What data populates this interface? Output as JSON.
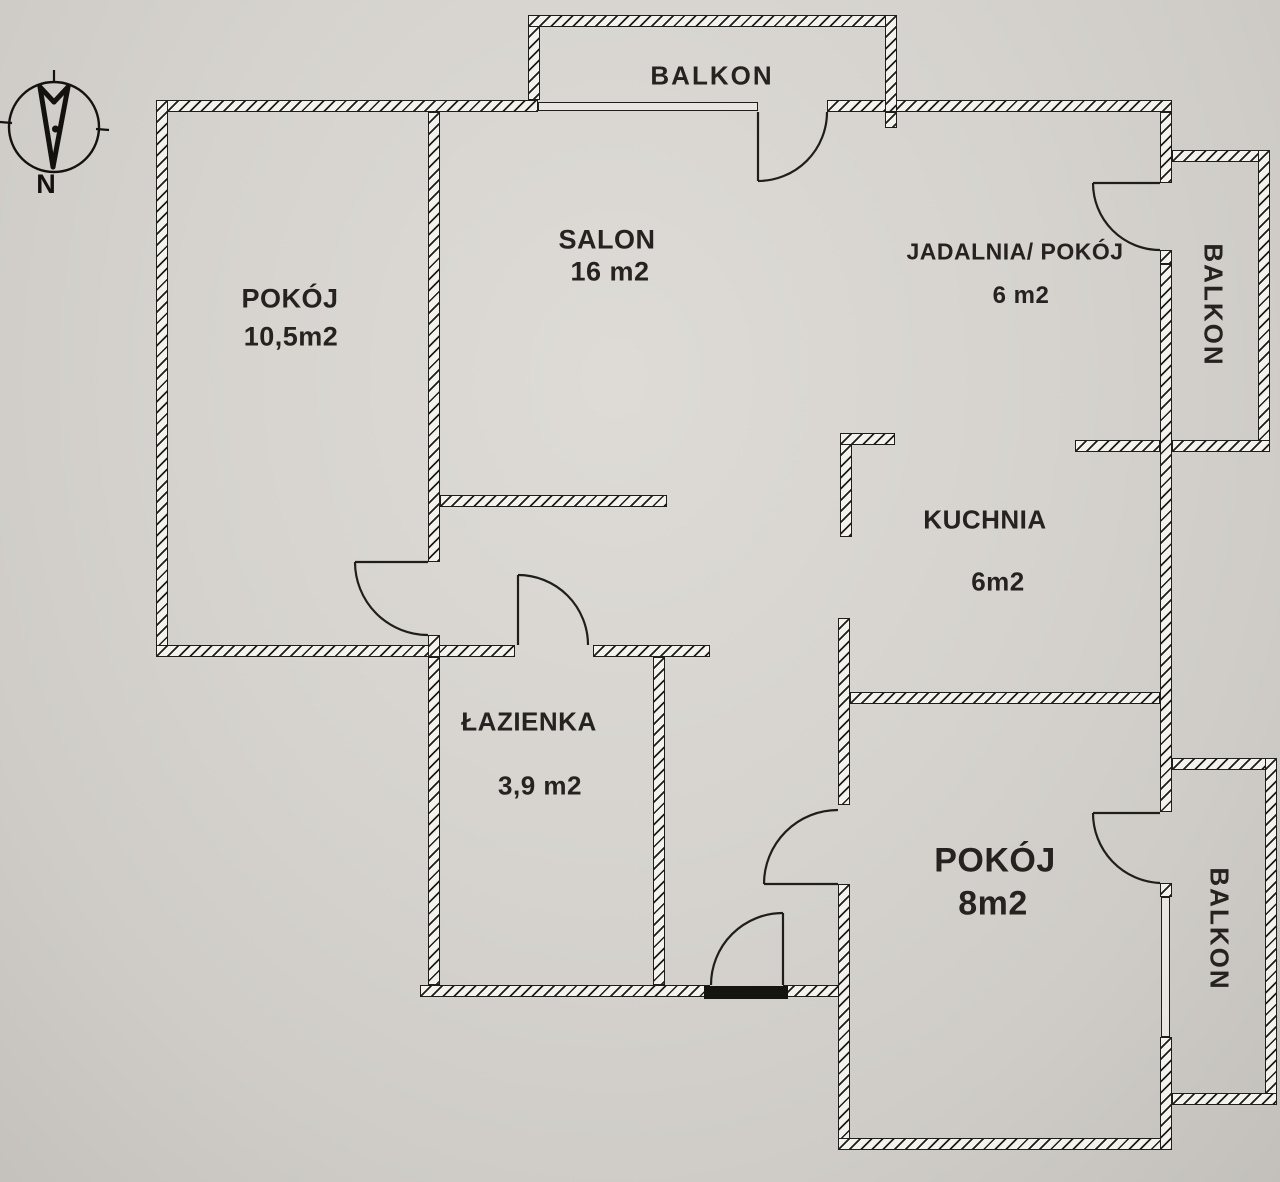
{
  "plan": {
    "title_hint": "apartment floor plan",
    "compass": {
      "north_label": "N"
    },
    "rooms": [
      {
        "id": "balkon-top",
        "label": "BALKON",
        "area": ""
      },
      {
        "id": "pokoj-1",
        "label": "POKÓJ",
        "area": "10,5m2"
      },
      {
        "id": "salon",
        "label": "SALON",
        "area": "16 m2"
      },
      {
        "id": "jadalnia-pokoj",
        "label": "JADALNIA/ POKÓJ",
        "area": "6 m2"
      },
      {
        "id": "balkon-right-upper",
        "label": "BALKON",
        "area": ""
      },
      {
        "id": "kuchnia",
        "label": "KUCHNIA",
        "area": "6m2"
      },
      {
        "id": "lazienka",
        "label": "ŁAZIENKA",
        "area": "3,9 m2"
      },
      {
        "id": "pokoj-8",
        "label": "POKÓJ",
        "area": "8m2"
      },
      {
        "id": "balkon-right-lower",
        "label": "BALKON",
        "area": ""
      }
    ],
    "colors": {
      "paper": "#d6d3ce",
      "line": "#201e1b",
      "wall_fill": "#f4f2ed"
    }
  }
}
